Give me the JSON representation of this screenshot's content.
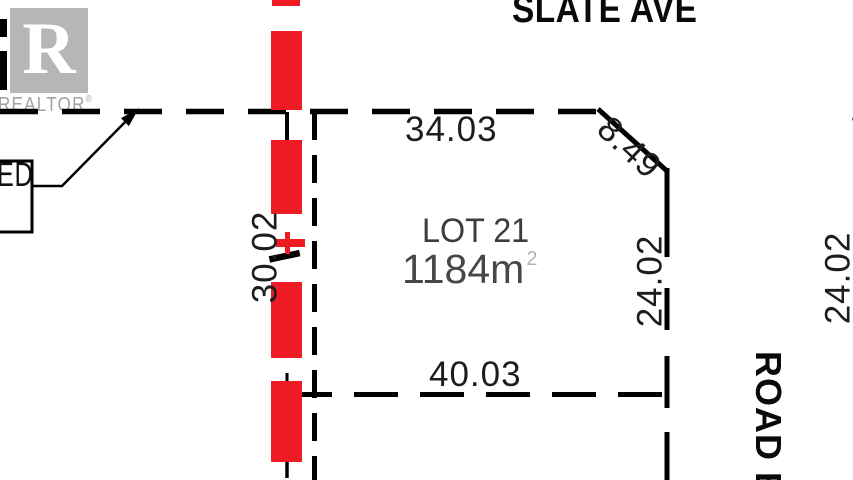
{
  "street": {
    "name": "SLATE AVE"
  },
  "lot": {
    "name": "LOT 21",
    "area": "1184m",
    "area_exponent": "2"
  },
  "dimensions": {
    "north": "34.03",
    "corner_chamfer": "8.49",
    "west": "30.02",
    "east": "24.02",
    "south": "40.03",
    "adjacent_east": "24.02",
    "adjacent_partial": "4"
  },
  "road": {
    "name": "ROAD E"
  },
  "callout": {
    "text": "ED"
  },
  "branding": {
    "logo_letter": "R",
    "wordmark": "REALTOR",
    "registered": "®"
  },
  "colors": {
    "highlight_red": "#ee1b24",
    "line_black": "#000000",
    "lot_text_gray": "#3f3f3f",
    "logo_gray": "#b6b6b6"
  }
}
